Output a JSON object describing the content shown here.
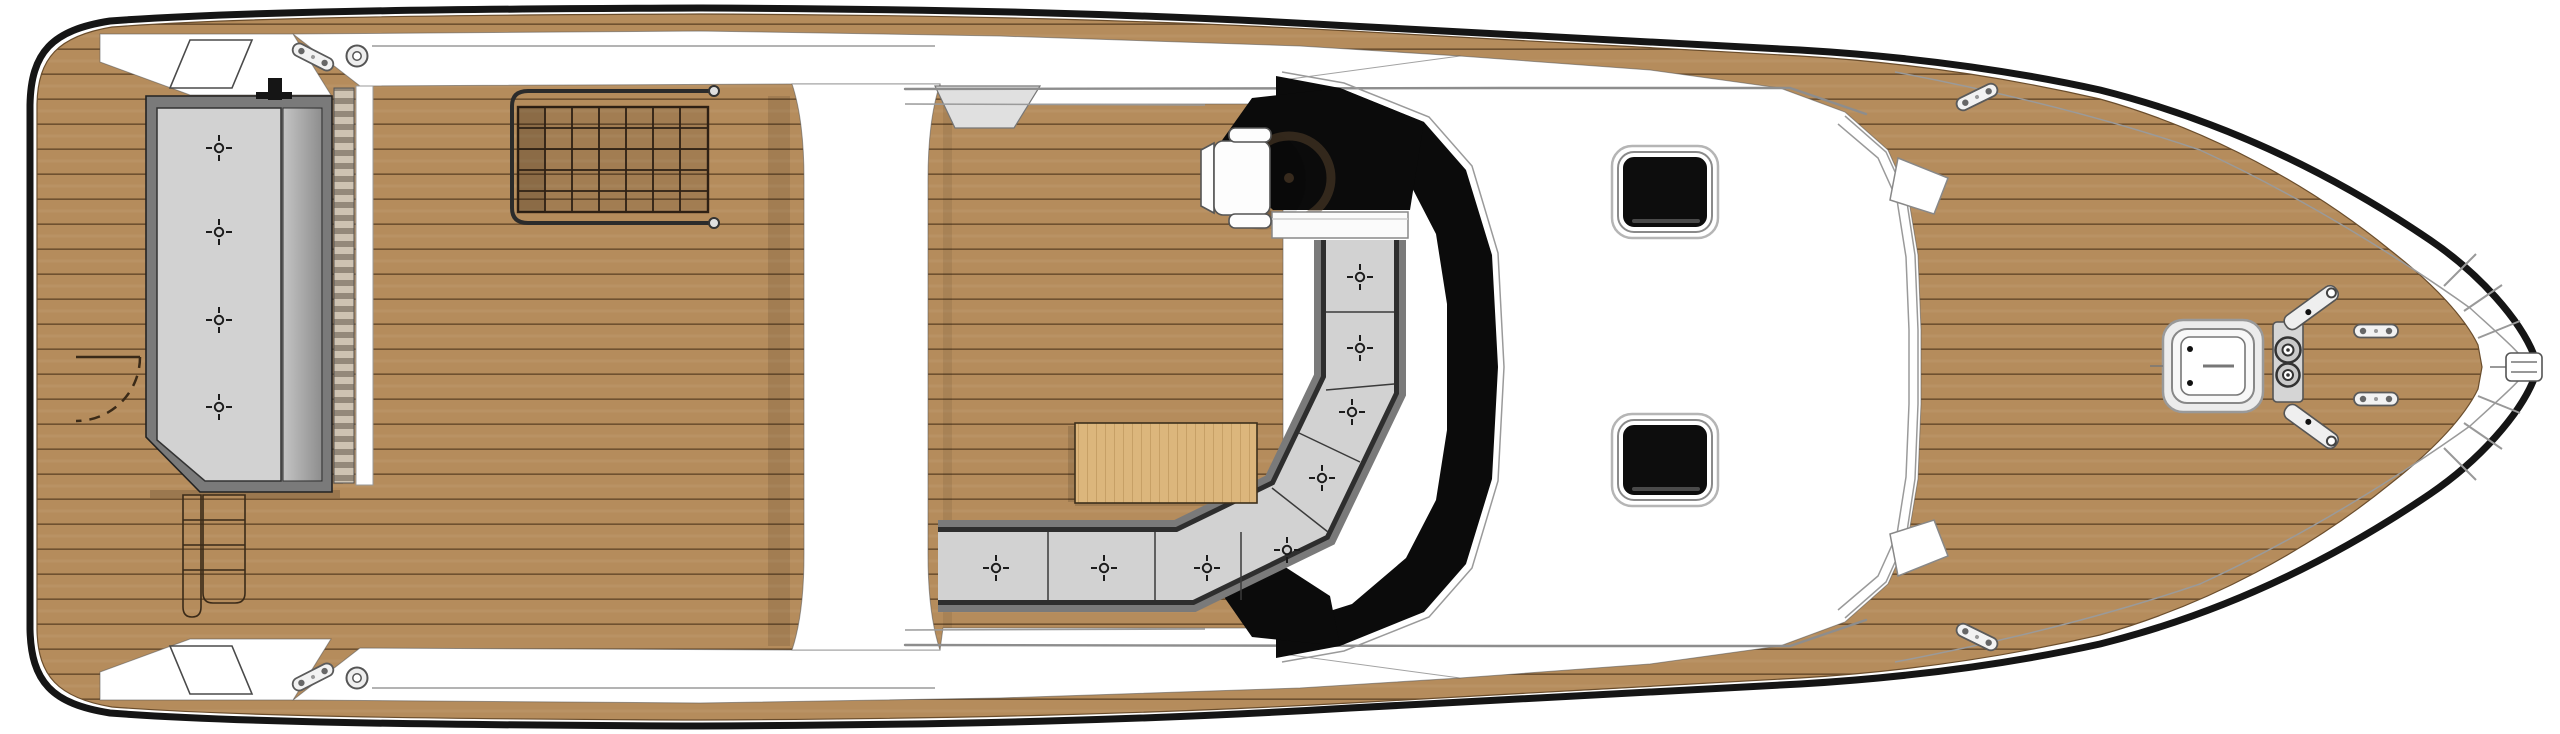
{
  "title": "Motor yacht deck plan — top-down view",
  "view": "exterior deck floor plan, bow pointing right",
  "palette": {
    "hull_line": "#151515",
    "deck_white": "#ffffff",
    "teak": "#b58c5c",
    "teak_seam": "#6f5130",
    "glass_black": "#0b0b0b",
    "cushion_gray": "#d2d2d2",
    "cushion_edge": "#2e2e2e",
    "frame_gray": "#7a7a7a",
    "table_wood": "#dcb67c",
    "table_grain": "#b18a50",
    "tread_light": "#cec3b2",
    "tread_dark": "#94897a",
    "fitting_white": "#f2f2f2",
    "fitting_stroke": "#5a5a5a",
    "rail_gray": "#8d8d8d"
  },
  "regions": {
    "stern": [
      "swim-platform",
      "transom-sunpad",
      "boarding-steps",
      "transom-door-swing",
      "stern-side-panels"
    ],
    "midship": [
      "aft-deck",
      "deck-hatch-grid-with-rail",
      "walkthrough-band",
      "cockpit",
      "dinette-table",
      "wraparound-bench",
      "helm-seat",
      "steering-wheel",
      "helm-console",
      "windshield"
    ],
    "forward": [
      "coachroof",
      "roof-skylight-aft",
      "roof-skylight-fwd",
      "foredeck",
      "bow-deck-hatch",
      "anchor-windlass",
      "bow-pulpit",
      "anchor-roller"
    ]
  },
  "fittings": {
    "sunpad_snap_buttons": 4,
    "bench_snap_buttons": 8,
    "roof_skylights": 2,
    "deck_cleats": 6,
    "fairleads": 2,
    "rail_knobs": 2,
    "windlass_drums": 2,
    "pulpit_spokes": 7
  }
}
